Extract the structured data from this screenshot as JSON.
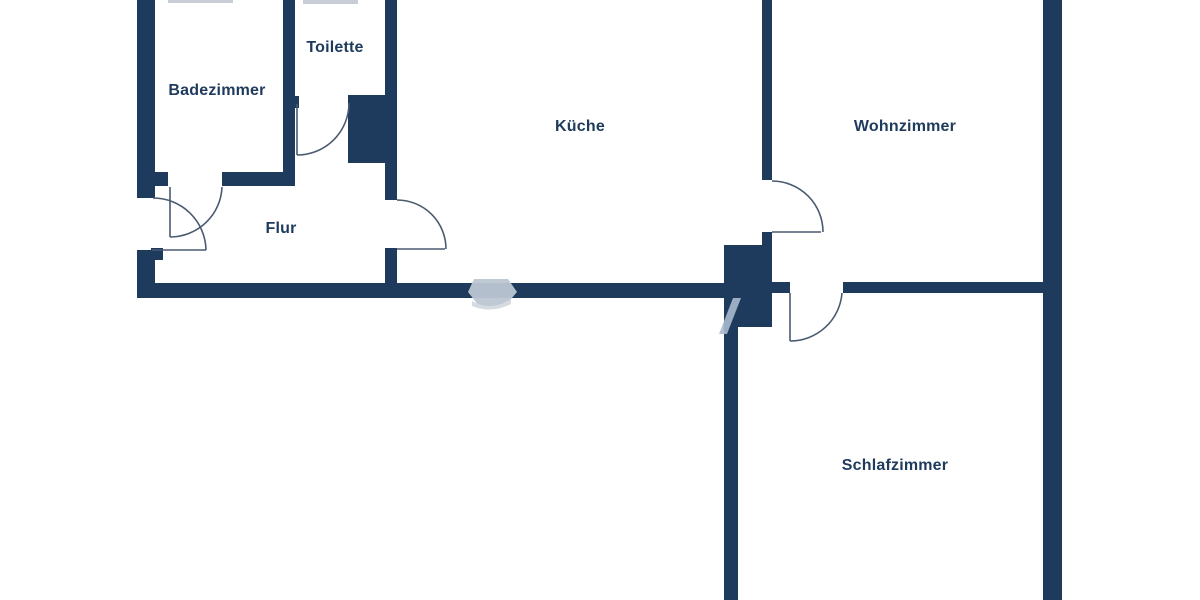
{
  "plan": {
    "title": "Apartment floor plan",
    "rooms": [
      {
        "id": "badezimmer",
        "label": "Badezimmer"
      },
      {
        "id": "toilette",
        "label": "Toilette"
      },
      {
        "id": "flur",
        "label": "Flur"
      },
      {
        "id": "kueche",
        "label": "Küche"
      },
      {
        "id": "wohnzimmer",
        "label": "Wohnzimmer"
      },
      {
        "id": "schlafzimmer",
        "label": "Schlafzimmer"
      }
    ],
    "colors": {
      "wall": "#1e3a5c",
      "door_line": "#4a5a70",
      "label_text": "#1e3a5c",
      "watermark": "#bcc6d2",
      "background": "#ffffff"
    }
  }
}
